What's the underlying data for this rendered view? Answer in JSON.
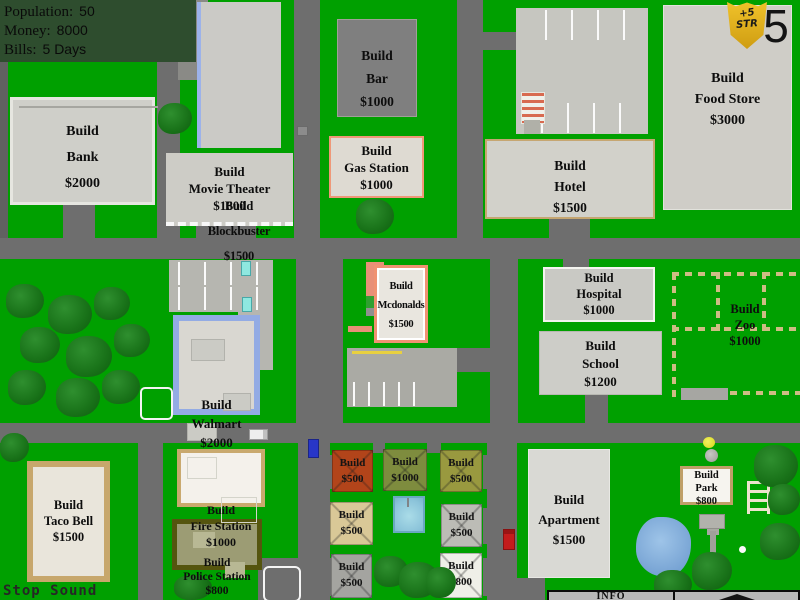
{
  "hud": {
    "rows": [
      {
        "label": "Population:",
        "value": "50"
      },
      {
        "label": "Money:",
        "value": "8000"
      },
      {
        "label": "Bills:",
        "value": "5 Days"
      }
    ]
  },
  "badge": {
    "top": "+5",
    "bottom": "STR",
    "counter": "5"
  },
  "buttons": {
    "bank": [
      "Build",
      "Bank",
      "$2000"
    ],
    "blockbuster": [
      "Build",
      "Blockbuster",
      "$1500"
    ],
    "movie_theater": [
      "Build",
      "Movie Theater",
      "$1600"
    ],
    "bar": [
      "Build",
      "Bar",
      "$1000"
    ],
    "gas_station": [
      "Build",
      "Gas Station",
      "$1000"
    ],
    "hotel": [
      "Build",
      "Hotel",
      "$1500"
    ],
    "food_store": [
      "Build",
      "Food Store",
      "$3000"
    ],
    "mcdonalds": [
      "Build",
      "Mcdonalds",
      "$1500"
    ],
    "hospital": [
      "Build",
      "Hospital",
      "$1000"
    ],
    "school": [
      "Build",
      "School",
      "$1200"
    ],
    "zoo": [
      "Build",
      "Zoo",
      "$1000"
    ],
    "walmart": [
      "Build",
      "Walmart",
      "$2000"
    ],
    "taco_bell": [
      "Build",
      "Taco Bell",
      "$1500"
    ],
    "fire_station": [
      "Build",
      "Fire Station",
      "$1000"
    ],
    "police_station": [
      "Build",
      "Police Station",
      "$800"
    ],
    "apartment": [
      "Build",
      "Apartment",
      "$1500"
    ],
    "park": [
      "Build",
      "Park",
      "$800"
    ]
  },
  "lots": [
    [
      "Build",
      "$500"
    ],
    [
      "Build",
      "$1000"
    ],
    [
      "Build",
      "$500"
    ],
    [
      "Build",
      "$500"
    ],
    [
      "Build",
      "$500"
    ],
    [
      "Build",
      "$500"
    ],
    [
      "Build",
      "$800"
    ]
  ],
  "footer": {
    "stop_sound": "Stop Sound",
    "info_label": "INFO"
  },
  "palette": {
    "map_green": "#00a000",
    "road_gray": "#6e6e6e",
    "hud_green": "#2e4d2e",
    "badge_gold": "#e8b81e"
  }
}
